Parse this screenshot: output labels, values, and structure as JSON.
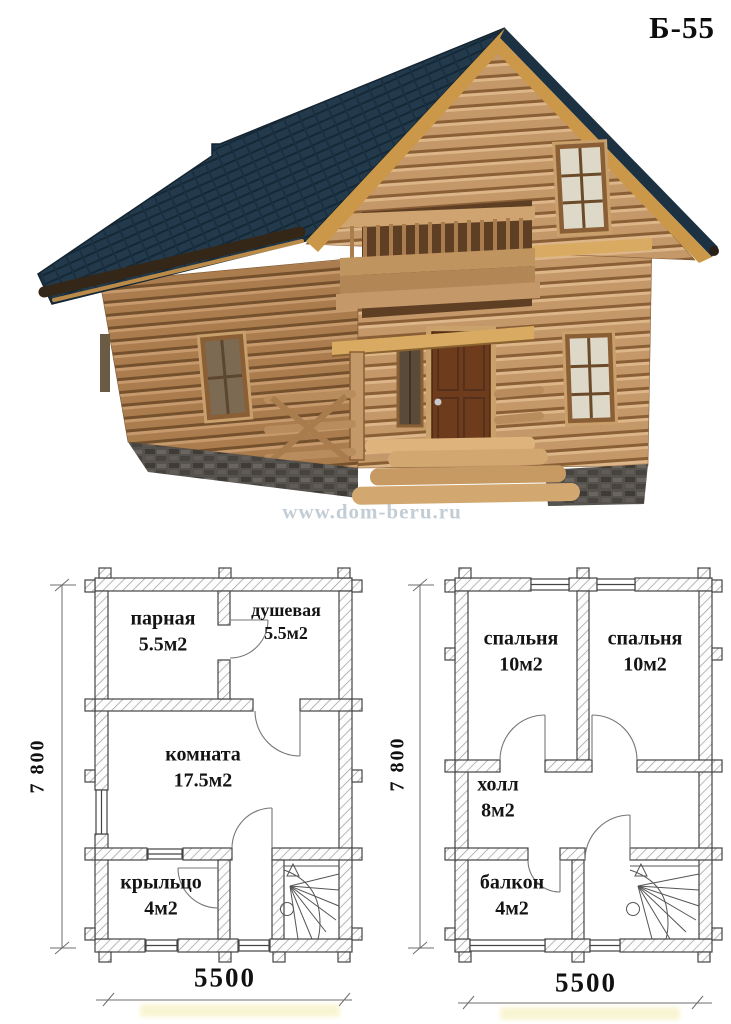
{
  "title": "Б-55",
  "watermark": "www.dom-beru.ru",
  "floor1": {
    "rooms": {
      "parnaya": {
        "name": "парная",
        "area": "5.5м2"
      },
      "dushevaya": {
        "name": "душевая",
        "area": "5.5м2"
      },
      "komnata": {
        "name": "комната",
        "area": "17.5м2"
      },
      "kryltso": {
        "name": "крыльцо",
        "area": "4м2"
      }
    },
    "dim_height": "7 800",
    "dim_width": "5500"
  },
  "floor2": {
    "rooms": {
      "spalnya1": {
        "name": "спальня",
        "area": "10м2"
      },
      "spalnya2": {
        "name": "спальня",
        "area": "10м2"
      },
      "kholl": {
        "name": "холл",
        "area": "8м2"
      },
      "balkon": {
        "name": "балкон",
        "area": "4м2"
      }
    },
    "dim_height": "7 800",
    "dim_width": "5500"
  },
  "colors": {
    "roof": "#223a4c",
    "wood_light": "#c49868",
    "wood_dark": "#ab7c4e",
    "fascia": "#cb9748",
    "foundation": "#56524d",
    "plan_line": "#444444",
    "watermark_text": "#b9c5ce"
  }
}
